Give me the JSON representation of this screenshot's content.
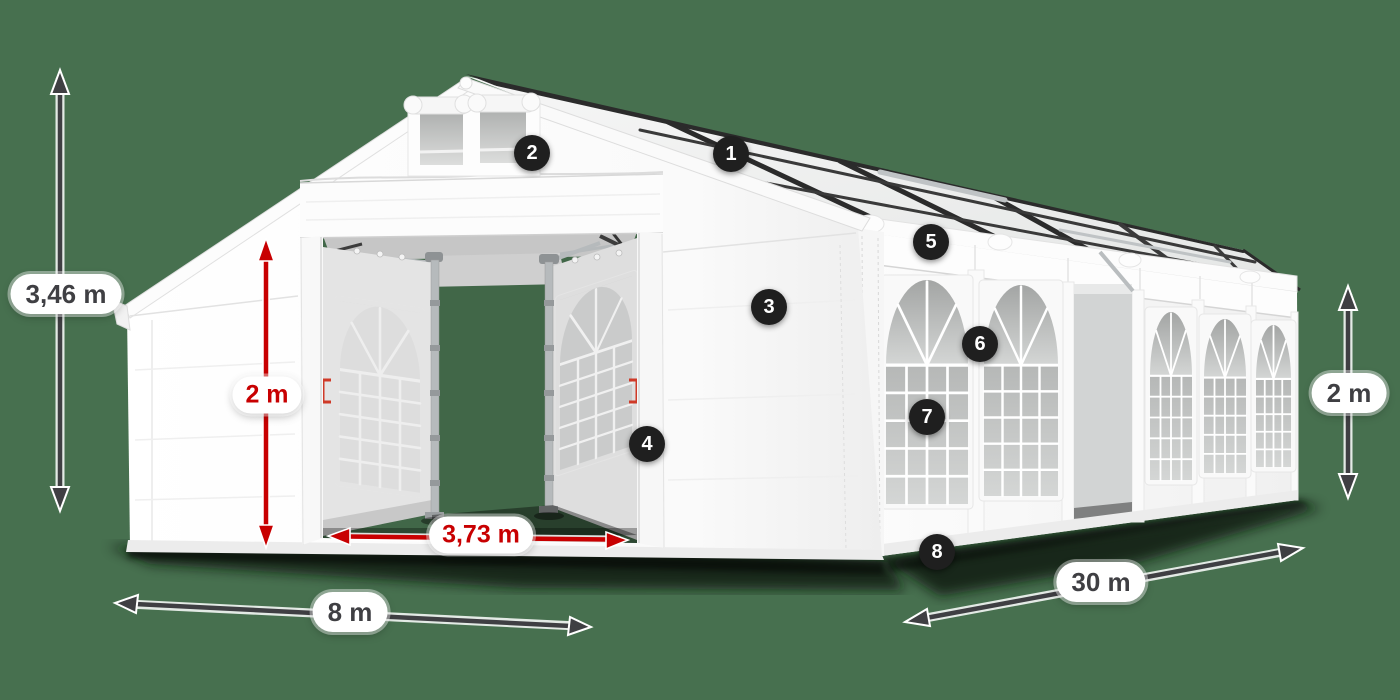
{
  "scene": {
    "background_color": "#47704f",
    "accent_red": "#c80001",
    "dimension_gray": "#3f3f43",
    "badge_background": "#1f1f1f",
    "tent_color": "#ffffff"
  },
  "dimension_labels": {
    "total_height": "3,46 m",
    "entrance_height": "2 m",
    "entrance_width": "3,73 m",
    "front_width": "8 m",
    "side_length": "30 m",
    "side_wall_height": "2 m"
  },
  "callouts": [
    {
      "number": "1"
    },
    {
      "number": "2"
    },
    {
      "number": "3"
    },
    {
      "number": "4"
    },
    {
      "number": "5"
    },
    {
      "number": "6"
    },
    {
      "number": "7"
    },
    {
      "number": "8"
    }
  ]
}
